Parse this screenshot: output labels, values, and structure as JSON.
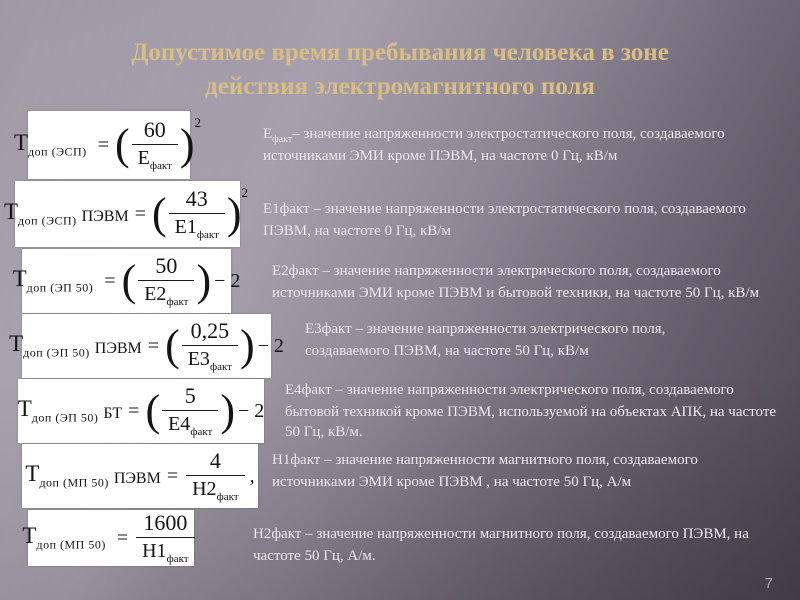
{
  "slide": {
    "title_line1": "Допустимое время пребывания человека в зоне",
    "title_line2": "действия электромагнитного поля",
    "page_number": "7",
    "colors": {
      "title_text": "#d8bd85",
      "body_text": "#efedf2",
      "background_light": "#a7a0ac",
      "background_dark": "#5c5764",
      "formula_box_bg": "#ffffff",
      "formula_text": "#141414"
    }
  },
  "formulas": [
    {
      "lhs": "T",
      "sub": "доп (ЭСП)",
      "suffix": "",
      "equals": "=",
      "open_paren": "(",
      "numerator": "60",
      "denominator": "Е",
      "denominator_sub": "факт",
      "close_paren": ")",
      "exponent": "2",
      "tail": ""
    },
    {
      "lhs": "T",
      "sub": "доп (ЭСП)",
      "suffix": "ПЭВМ",
      "equals": "=",
      "open_paren": "(",
      "numerator": "43",
      "denominator": "Е1",
      "denominator_sub": "факт",
      "close_paren": ")",
      "exponent": "2",
      "tail": ""
    },
    {
      "lhs": "T",
      "sub": "доп (ЭП 50)",
      "suffix": "",
      "equals": "=",
      "open_paren": "(",
      "numerator": "50",
      "denominator": "Е2",
      "denominator_sub": "факт",
      "close_paren": ")",
      "exponent": "",
      "tail": "− 2"
    },
    {
      "lhs": "T",
      "sub": "доп (ЭП 50)",
      "suffix": "ПЭВМ",
      "equals": "=",
      "open_paren": "(",
      "numerator": "0,25",
      "denominator": "Е3",
      "denominator_sub": "факт",
      "close_paren": ")",
      "exponent": "",
      "tail": "− 2"
    },
    {
      "lhs": "T",
      "sub": "доп (ЭП 50)",
      "suffix": "БТ",
      "equals": "=",
      "open_paren": "(",
      "numerator": "5",
      "denominator": "Е4",
      "denominator_sub": "факт",
      "close_paren": ")",
      "exponent": "",
      "tail": "− 2"
    },
    {
      "lhs": "T",
      "sub": "доп (МП 50)",
      "suffix": "ПЭВМ",
      "equals": "=",
      "open_paren": "",
      "numerator": "4",
      "denominator": "Н2",
      "denominator_sub": "факт",
      "close_paren": "",
      "exponent": "",
      "tail": ","
    },
    {
      "lhs": "T",
      "sub": "доп (МП 50)",
      "suffix": "",
      "equals": "=",
      "open_paren": "",
      "numerator": "1600",
      "denominator": "Н1",
      "denominator_sub": "факт",
      "close_paren": "",
      "exponent": "",
      "tail": ""
    }
  ],
  "descriptions": [
    {
      "lead": "Е",
      "lead_sub": "факт",
      "body": "– значение напряженности электростатического поля, создаваемого источниками ЭМИ кроме ПЭВМ, на частоте 0 Гц, кВ/м"
    },
    {
      "lead": "Е1факт",
      "lead_sub": "",
      "body": " – значение напряженности электростатического поля, создаваемого ПЭВМ, на частоте 0 Гц, кВ/м"
    },
    {
      "lead": "Е2факт",
      "lead_sub": "",
      "body": " –  значение напряженности электрического поля, создаваемого источниками ЭМИ кроме ПЭВМ и бытовой техники, на частоте 50 Гц, кВ/м"
    },
    {
      "lead": "Е3факт",
      "lead_sub": "",
      "body": " –  значение напряженности электрического поля, создаваемого ПЭВМ, на частоте 50 Гц, кВ/м"
    },
    {
      "lead": "Е4факт",
      "lead_sub": "",
      "body": " –  значение напряженности электрического поля, создаваемого бытовой техникой кроме ПЭВМ, используемой на объектах АПК, на частоте 50 Гц, кВ/м."
    },
    {
      "lead": "Н1факт",
      "lead_sub": "",
      "body": " – значение напряженности магнитного поля, создаваемого источниками ЭМИ кроме ПЭВМ , на частоте 50 Гц, А/м"
    },
    {
      "lead": "Н2факт",
      "lead_sub": "",
      "body": " – значение напряженности магнитного поля, создаваемого ПЭВМ, на частоте 50 Гц, А/м."
    }
  ]
}
